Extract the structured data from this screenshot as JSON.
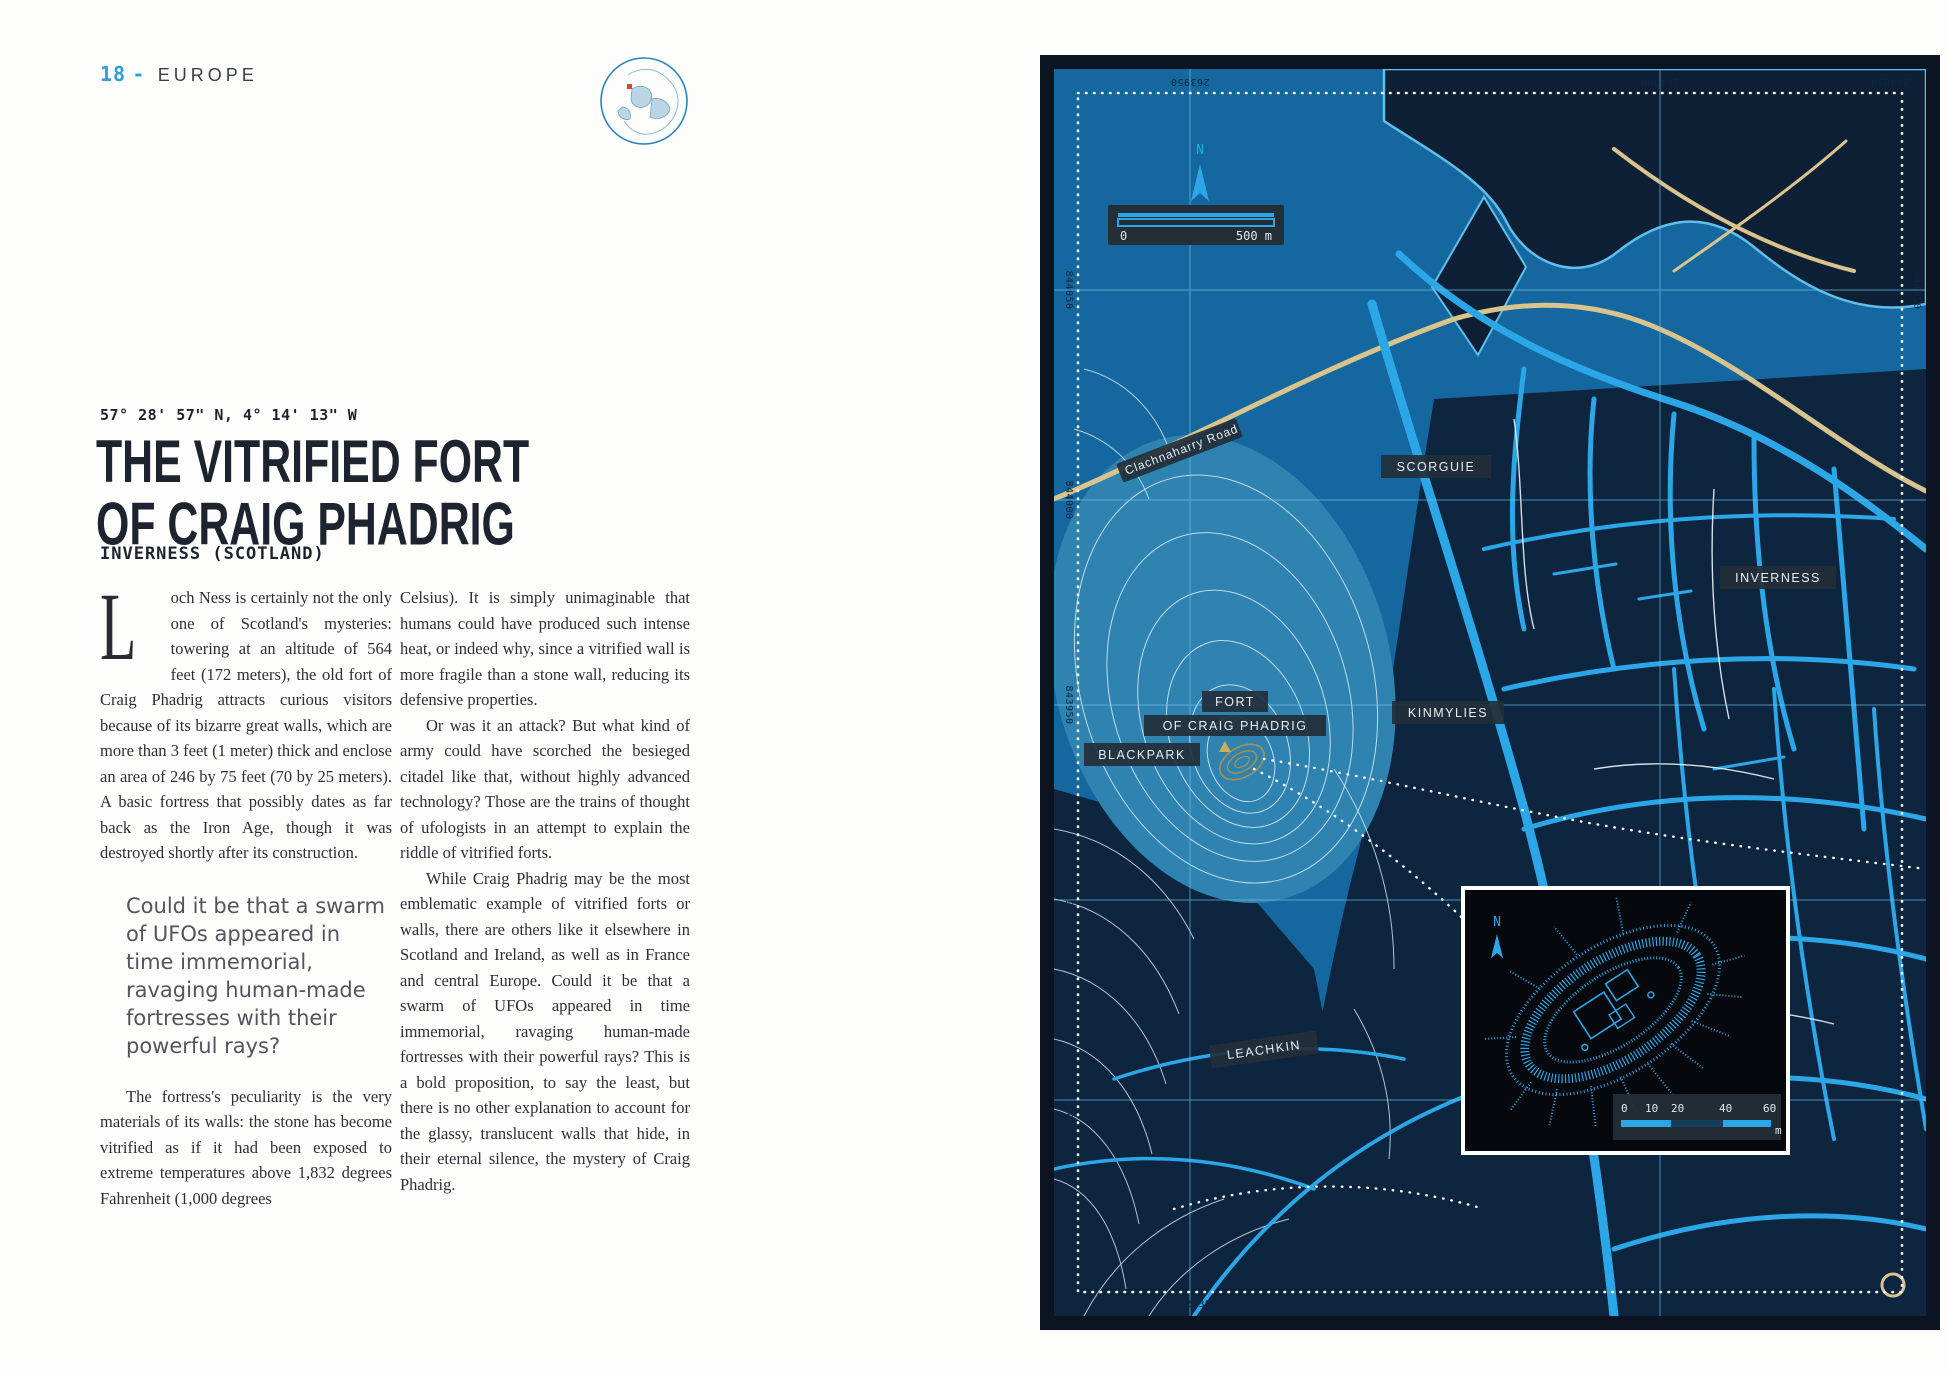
{
  "page": {
    "number": "18",
    "separator": "-",
    "section": "EUROPE"
  },
  "article": {
    "coordinates": "57° 28' 57\" N, 4° 14' 13\" W",
    "title_line1": "THE VITRIFIED FORT",
    "title_line2": "OF CRAIG PHADRIG",
    "subtitle": "INVERNESS (SCOTLAND)",
    "dropcap": "L",
    "col1_para1": "och Ness is certainly not the only one of Scotland's mysteries: towering at an altitude of 564 feet (172 meters), the old fort of Craig Phadrig attracts curious visitors because of its bizarre great walls, which are more than 3 feet (1 meter) thick and enclose an area of 246 by 75 feet (70 by 25 meters). A basic fortress that possibly dates as far back as the Iron Age, though it was destroyed shortly after its construction.",
    "pull_quote": "Could it be that a swarm of UFOs appeared in time immemorial, ravaging human-made fortresses with their powerful rays?",
    "col1_para2": "The fortress's peculiarity is the very materials of its walls: the stone has become vitrified as if it had been exposed to extreme temperatures above 1,832 degrees Fahrenheit (1,000 degrees",
    "col2_para1": "Celsius). It is simply unimaginable that humans could have produced such intense heat, or indeed why, since a vitrified wall is more fragile than a stone wall, reducing its defensive properties.",
    "col2_para2": "Or was it an attack? But what kind of army could have scorched the besieged citadel like that, without highly advanced technology? Those are the trains of thought of ufologists in an attempt to explain the riddle of vitrified forts.",
    "col2_para3": "While Craig Phadrig may be the most emblematic example of vitrified forts or walls, there are others like it elsewhere in Scotland and Ireland, as well as in France and central Europe. Could it be that a swarm of UFOs appeared in time immemorial, ravaging human-made fortresses with their powerful rays? This is a bold proposition, to say the least, but there is no other explanation to account for the glassy, translucent walls that hide, in their eternal silence, the mystery of Craig Phadrig."
  },
  "map": {
    "north_label": "N",
    "scale_bar": {
      "start": "0",
      "end": "500 m"
    },
    "grid": {
      "top": [
        "263950",
        "264000",
        "264050"
      ],
      "bottom": [
        "263950",
        "264000",
        "264050"
      ],
      "left": [
        "844050",
        "844000",
        "843950",
        "843900",
        "843850"
      ],
      "right": [
        "844050",
        "843950"
      ]
    },
    "labels": {
      "road": "Clachnaharry Road",
      "scorguie": "SCORGUIE",
      "inverness": "INVERNESS",
      "fort_line1": "FORT",
      "fort_line2": "OF CRAIG PHADRIG",
      "kinmylies": "KINMYLIES",
      "blackpark": "BLACKPARK",
      "leachkin": "LEACHKIN"
    },
    "inset": {
      "north_label": "N",
      "scale_ticks": [
        "0",
        "10",
        "20",
        "40",
        "60"
      ],
      "scale_unit": "m"
    },
    "colors": {
      "base": "#15679f",
      "water": "#0d2036",
      "urban": "#0e2540",
      "hill": "#2f83b0",
      "street": "#2ba7e8",
      "tan_road": "#d9c48d",
      "contour": "#d8ecf5",
      "frame": "#0b1420",
      "badge": "#232e38",
      "accent": "#2b9fd8",
      "fort_ring": "#a8924e"
    }
  }
}
